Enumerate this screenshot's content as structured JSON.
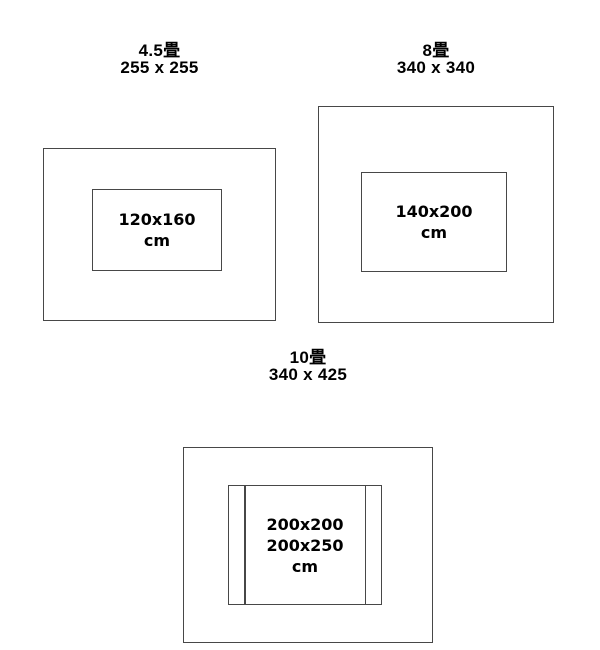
{
  "page": {
    "background": "#ffffff",
    "line_color": "#474747",
    "text_color": "#000000"
  },
  "diagrams": [
    {
      "id": "4.5-tatami",
      "room_label": "4.5畳",
      "room_size_cm": "255 x 255",
      "rug_sizes": [
        "120x160"
      ],
      "rug_unit": "cm"
    },
    {
      "id": "8-tatami",
      "room_label": "8畳",
      "room_size_cm": "340 x 340",
      "rug_sizes": [
        "140x200"
      ],
      "rug_unit": "cm"
    },
    {
      "id": "10-tatami",
      "room_label": "10畳",
      "room_size_cm": "340 x 425",
      "rug_sizes": [
        "200x200",
        "200x250"
      ],
      "rug_unit": "cm"
    }
  ]
}
